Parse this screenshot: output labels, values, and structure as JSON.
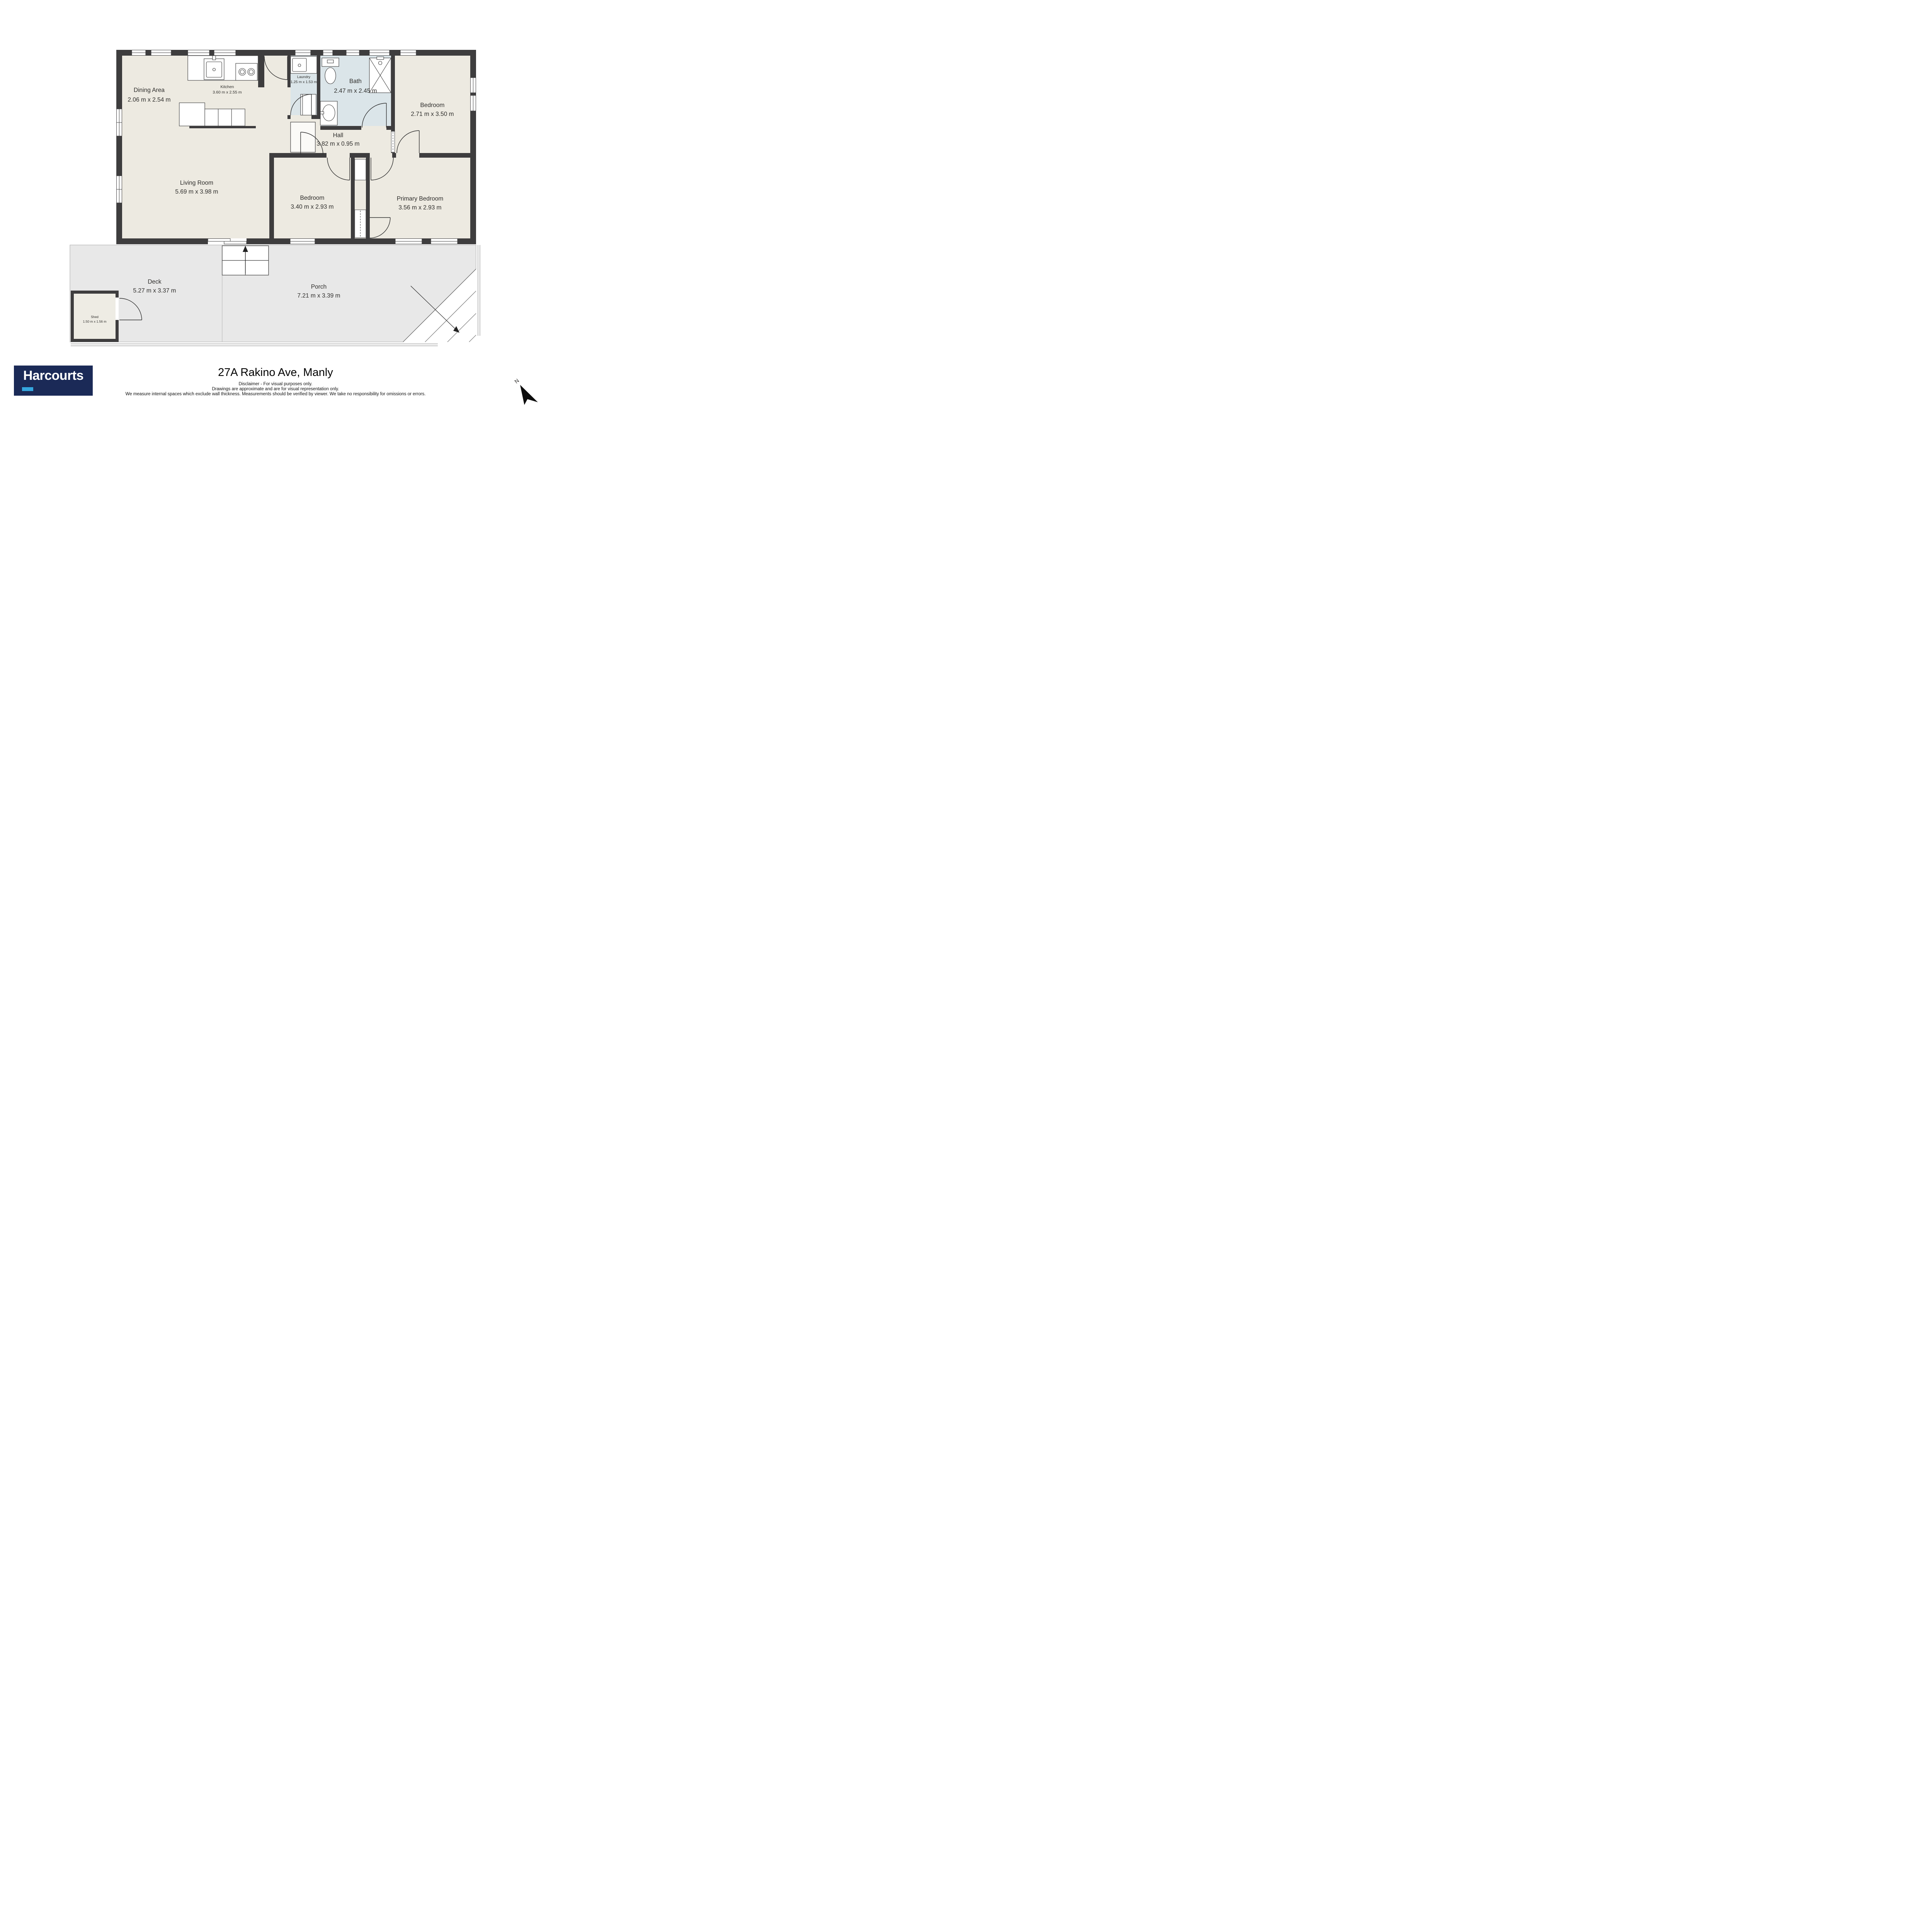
{
  "rooms": [
    {
      "name": "Dining Area",
      "dims": "2.06 m x 2.54 m"
    },
    {
      "name": "Kitchen",
      "dims": "3.60 m x 2.55 m"
    },
    {
      "name": "Laundry",
      "dims": "1.25 m x 1.53 m"
    },
    {
      "name": "Bath",
      "dims": "2.47 m x 2.45 m"
    },
    {
      "name": "Bedroom",
      "dims": "2.71 m x 3.50 m"
    },
    {
      "name": "Hall",
      "dims": "3.82 m x 0.95 m"
    },
    {
      "name": "Living Room",
      "dims": "5.69 m x 3.98 m"
    },
    {
      "name": "Bedroom",
      "dims": "3.40 m x 2.93 m"
    },
    {
      "name": "Primary Bedroom",
      "dims": "3.56 m x 2.93 m"
    },
    {
      "name": "Deck",
      "dims": "5.27 m x 3.37 m"
    },
    {
      "name": "Porch",
      "dims": "7.21 m x 3.39 m"
    },
    {
      "name": "Shed",
      "dims": "1.50 m x 1.56 m"
    }
  ],
  "footer": {
    "brand": "Harcourts",
    "title": "27A Rakino Ave, Manly",
    "disclaimer_lines": [
      "Disclaimer - For visual purposes only.",
      "Drawings are approximate and are for visual representation only.",
      "We measure internal spaces which exclude wall thickness. Measurements should be verified by viewer. We take no responsibility for omissions or errors."
    ]
  },
  "compass": {
    "label": "N"
  },
  "colors": {
    "wall": "#3e3d3e",
    "floor": "#edeae1",
    "wet_area": "#dbe5e9",
    "outdoor": "#e8e8e8",
    "brand_navy": "#1b2a57",
    "brand_cyan": "#35a7df"
  }
}
